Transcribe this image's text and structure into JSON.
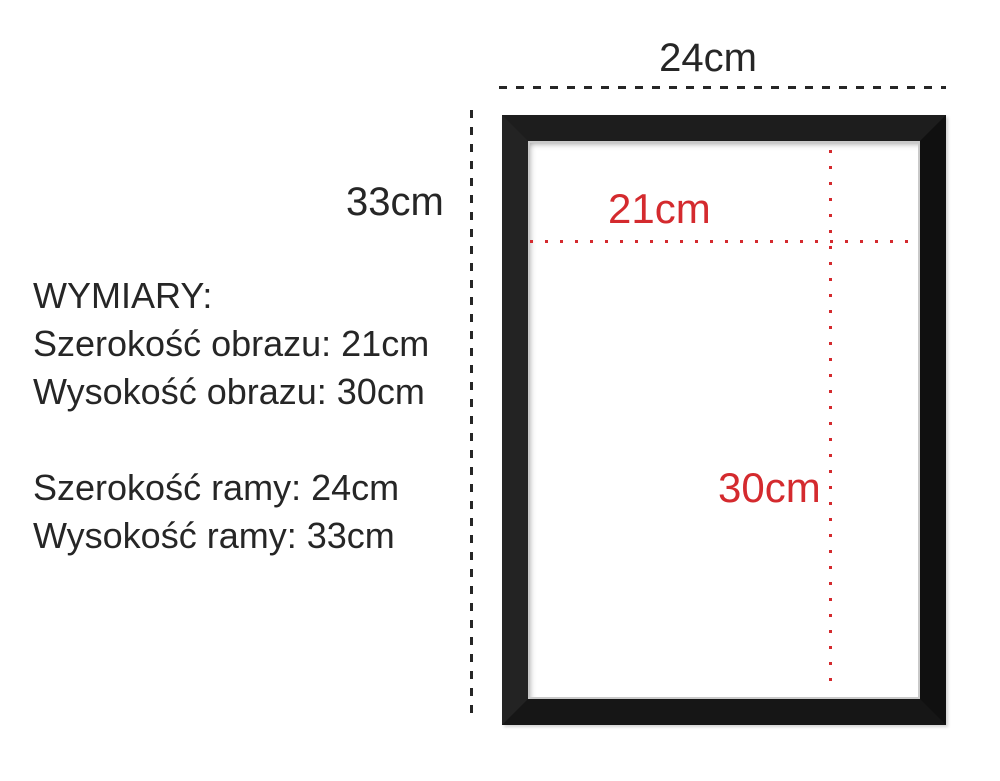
{
  "colors": {
    "black": "#262626",
    "red": "#d42a2e",
    "frame": "#1a1a1a"
  },
  "frame_diagram": {
    "outer_width_label": "24cm",
    "outer_height_label": "33cm",
    "inner_width_label": "21cm",
    "inner_height_label": "30cm"
  },
  "specs": {
    "heading": "WYMIARY:",
    "lines": [
      "Szerokość obrazu: 21cm",
      "Wysokość obrazu: 30cm",
      "",
      "Szerokość ramy: 24cm",
      "Wysokość ramy: 33cm"
    ]
  }
}
